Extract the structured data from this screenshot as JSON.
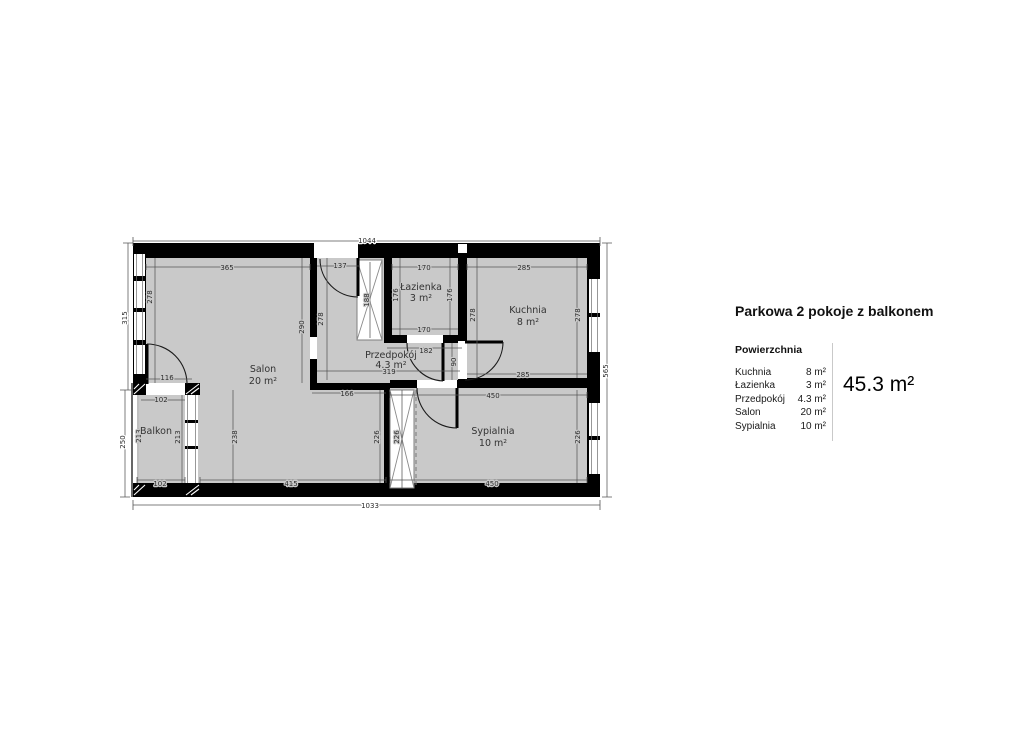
{
  "plan": {
    "rooms": {
      "salon": {
        "name": "Salon",
        "area": "20 m²"
      },
      "kuchnia": {
        "name": "Kuchnia",
        "area": "8 m²"
      },
      "lazienka": {
        "name": "Łazienka",
        "area": "3 m²"
      },
      "przedpokoj": {
        "name": "Przedpokój",
        "area": "4.3 m²"
      },
      "sypialnia": {
        "name": "Sypialnia",
        "area": "10 m²"
      },
      "balkon": {
        "name": "Balkon"
      }
    },
    "dims": {
      "top_total": "1044",
      "bottom_total": "1033",
      "left_upper": "315",
      "left_lower": "250",
      "right_total": "565",
      "salon_north": "365",
      "salon_west": "278",
      "salon_east": "290",
      "salon_south": "415",
      "salon_se_wall": "166",
      "salon_west_lower": "238",
      "balcony_door": "116",
      "balkon_north": "102",
      "balkon_south": "102",
      "balkon_west": "213",
      "balkon_east": "213",
      "entry_wall": "137",
      "entry_wardrobe": "188",
      "przedpokoj_west": "278",
      "przedpokoj_width": "319",
      "przedpokoj_east_wall": "182",
      "kitchen_door_wall": "90",
      "lazienka_north": "170",
      "lazienka_south": "170",
      "lazienka_west": "176",
      "lazienka_east": "176",
      "kuchnia_north": "285",
      "kuchnia_south": "285",
      "kuchnia_west": "278",
      "kuchnia_east": "278",
      "sypialnia_north": "450",
      "sypialnia_south": "450",
      "sypialnia_west": "226",
      "sypialnia_wardrobe": "226",
      "sypialnia_east": "226"
    },
    "colors": {
      "floor": "#c9c9c9",
      "wall": "#000000",
      "dim_text": "#2b2b2b"
    }
  },
  "legend": {
    "title": "Parkowa 2 pokoje z balkonem",
    "section_title": "Powierzchnia",
    "rows": [
      {
        "name": "Kuchnia",
        "area": "8 m²"
      },
      {
        "name": "Łazienka",
        "area": "3 m²"
      },
      {
        "name": "Przedpokój",
        "area": "4.3 m²"
      },
      {
        "name": "Salon",
        "area": "20 m²"
      },
      {
        "name": "Sypialnia",
        "area": "10 m²"
      }
    ],
    "total": "45.3 m²"
  }
}
